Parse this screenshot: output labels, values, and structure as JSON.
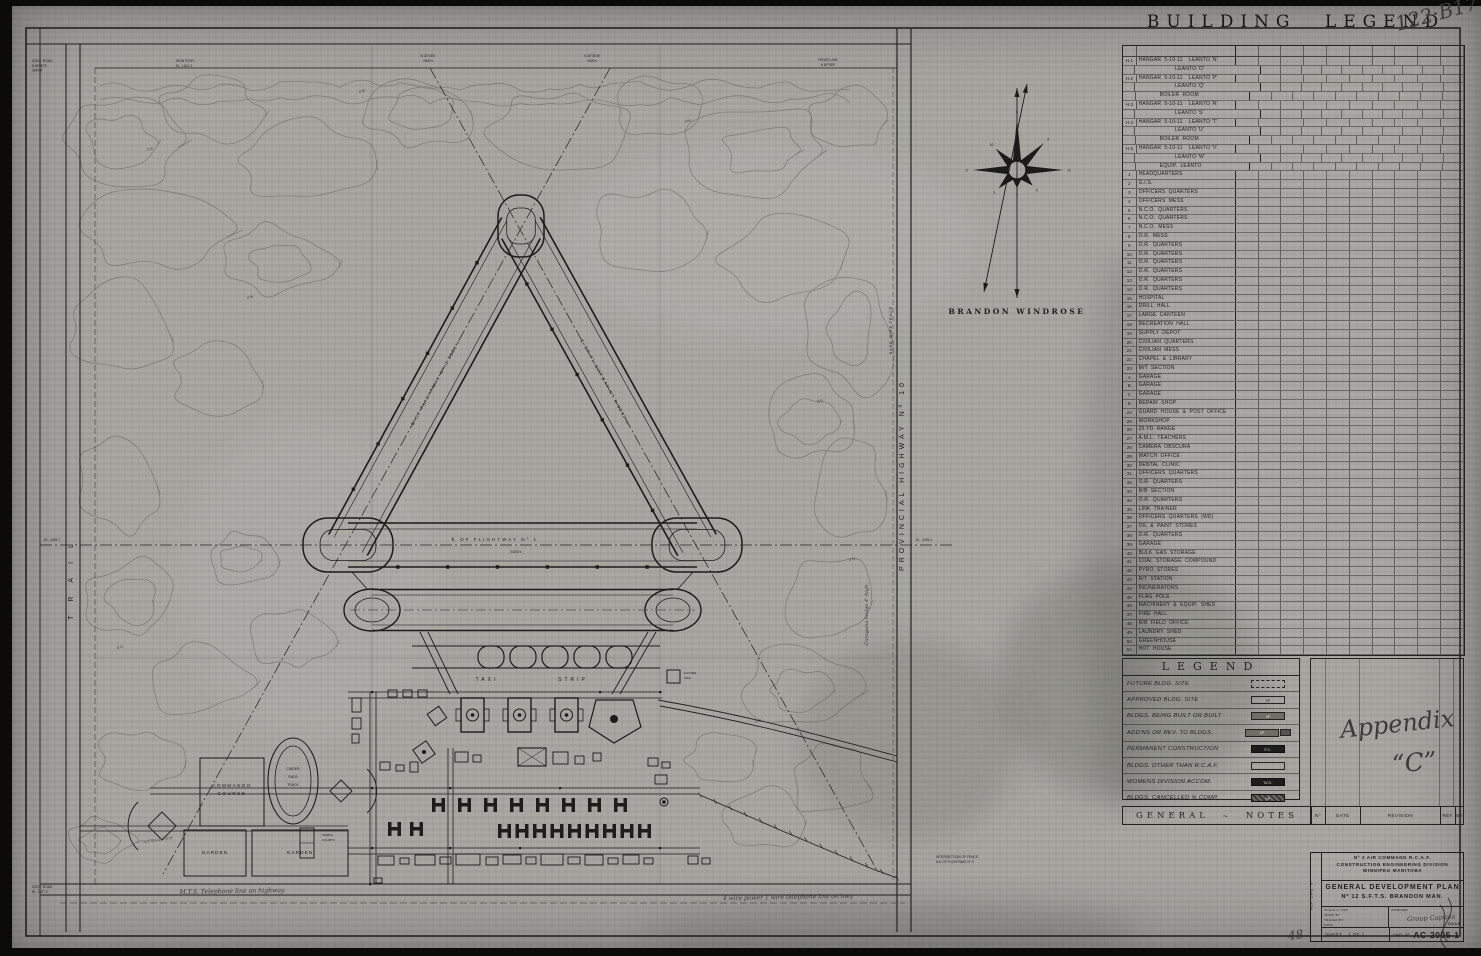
{
  "sheet": {
    "handwritten_ref": "122·B17",
    "handwritten_appendix_1": "Appendix",
    "handwritten_appendix_2": "“C”",
    "handwritten_48": "48"
  },
  "building_legend": {
    "title": "BUILDING LEGEND",
    "rows": [
      [
        "H.1",
        "HANGAR  5-10-11    LEANTO 'N'",
        0
      ],
      [
        "",
        "LEANTO 'O'",
        2
      ],
      [
        "H.2",
        "HANGAR  5-10-11    LEANTO 'P'",
        0
      ],
      [
        "",
        "LEANTO 'Q'",
        2
      ],
      [
        "",
        "BOILER  ROOM",
        1
      ],
      [
        "H.3",
        "HANGAR  5-10-11    LEANTO 'R'",
        0
      ],
      [
        "",
        "LEANTO 'S'",
        2
      ],
      [
        "H.4",
        "HANGAR  5-10-11    LEANTO 'T'",
        0
      ],
      [
        "",
        "LEANTO 'U'",
        2
      ],
      [
        "",
        "BOILER  ROOM",
        1
      ],
      [
        "H.5",
        "HANGAR  5-10-11    LEANTO 'V'",
        0
      ],
      [
        "",
        "LEANTO 'W'",
        2
      ],
      [
        "",
        "EQUIP.  LEANTO",
        1
      ],
      [
        "1",
        "HEADQUARTERS",
        0
      ],
      [
        "2",
        "G.I.S.",
        0
      ],
      [
        "3",
        "OFFICERS  QUARTERS",
        0
      ],
      [
        "4",
        "OFFICERS  MESS",
        0
      ],
      [
        "5",
        "N.C.O.  QUARTERS",
        0
      ],
      [
        "6",
        "N.C.O.  QUARTERS",
        0
      ],
      [
        "7",
        "N.C.O.  MESS",
        0
      ],
      [
        "8",
        "O.R.  MESS",
        0
      ],
      [
        "9",
        "O.R.  QUARTERS",
        0
      ],
      [
        "10",
        "O.R.  QUARTERS",
        0
      ],
      [
        "11",
        "O.R.  QUARTERS",
        0
      ],
      [
        "12",
        "O.R.  QUARTERS",
        0
      ],
      [
        "13",
        "O.R.  QUARTERS",
        0
      ],
      [
        "14",
        "O.R.  QUARTERS",
        0
      ],
      [
        "15",
        "HOSPITAL",
        0
      ],
      [
        "16",
        "DRILL  HALL",
        0
      ],
      [
        "17",
        "LARGE  CANTEEN",
        0
      ],
      [
        "18",
        "RECREATION  HALL",
        0
      ],
      [
        "19",
        "SUPPLY  DEPOT",
        0
      ],
      [
        "20",
        "CIVILIAN  QUARTERS",
        0
      ],
      [
        "21",
        "CIVILIAN  MESS",
        0
      ],
      [
        "22",
        "CHAPEL  &  LIBRARY",
        0
      ],
      [
        "23",
        "M/T  SECTION",
        0
      ],
      [
        "A",
        "GARAGE",
        0
      ],
      [
        "B",
        "GARAGE",
        0
      ],
      [
        "C",
        "GARAGE",
        0
      ],
      [
        "D",
        "REPAIR  SHOP",
        0
      ],
      [
        "24",
        "GUARD  HOUSE  &  POST  OFFICE",
        0
      ],
      [
        "25",
        "WORKSHOP",
        0
      ],
      [
        "26",
        "25 YD. RANGE",
        0
      ],
      [
        "27",
        "A.M.L.  TEACHERS",
        0
      ],
      [
        "28",
        "CAMERA  OBSCURA",
        0
      ],
      [
        "29",
        "WATCH  OFFICE",
        0
      ],
      [
        "30",
        "DENTAL  CLINIC",
        0
      ],
      [
        "31",
        "OFFICERS  QUARTERS",
        0
      ],
      [
        "32",
        "O.R.  QUARTERS",
        0
      ],
      [
        "33",
        "R/B  SECTION",
        0
      ],
      [
        "34",
        "O.R.  QUARTERS",
        0
      ],
      [
        "35",
        "LINK  TRAINER",
        0
      ],
      [
        "36",
        "OFFICERS  QUARTERS  (WD)",
        0
      ],
      [
        "37",
        "OIL  &  PAINT  STORES",
        0
      ],
      [
        "38",
        "O.R.  QUARTERS",
        0
      ],
      [
        "39",
        "GARAGE",
        0
      ],
      [
        "40",
        "BULK  GAS  STORAGE",
        0
      ],
      [
        "41",
        "COAL  STORAGE  COMPOUND",
        0
      ],
      [
        "42",
        "PYRO  STORES",
        0
      ],
      [
        "43",
        "R/T  STATION",
        0
      ],
      [
        "44",
        "INCINERATORS",
        0
      ],
      [
        "45",
        "FLAG  POLE",
        0
      ],
      [
        "46",
        "MACHINERY  &  EQUIP.  SHED",
        0
      ],
      [
        "47",
        "FIRE  HALL",
        0
      ],
      [
        "48",
        "R/B  FIELD  OFFICE",
        0
      ],
      [
        "49",
        "LAUNDRY  SHED",
        0
      ],
      [
        "50",
        "GREENHOUSE",
        0
      ],
      [
        "51",
        "HOT  HOUSE",
        0
      ]
    ]
  },
  "legend": {
    "title": "LEGEND",
    "items": [
      [
        "FUTURE BLDG. SITE",
        "dashed",
        ""
      ],
      [
        "APPROVED BLDG. SITE",
        "outline",
        "Nº"
      ],
      [
        "BLDGS. BEING BUILT OR BUILT",
        "filled",
        "Nº"
      ],
      [
        "ADD'NS OR REV. TO BLDGS.",
        "addn",
        "Nº"
      ],
      [
        "PERMANENT CONSTRUCTION",
        "solid",
        "P.C."
      ],
      [
        "BLDGS. OTHER THAN R.C.A.F.",
        "outline",
        ""
      ],
      [
        "WOMENS DIVISION ACCOM.",
        "solid",
        "W.D."
      ],
      [
        "BLDGS. CANCELLED % COMP.",
        "hatched",
        "Nº"
      ]
    ]
  },
  "general_notes": {
    "left": "GENERAL",
    "squiggle": "~",
    "right": "NOTES"
  },
  "revision": {
    "no": "Nº",
    "date": "DATE",
    "revision": "REVISION",
    "ref": "REF.",
    "by": "BY"
  },
  "title_block": {
    "org_line1": "Nº 2 AIR COMMAND  R.C.A.F.",
    "org_line2": "CONSTRUCTION  ENGINEERING  DIVISION",
    "org_line3": "WINNIPEG        MANITOBA",
    "plan_line1": "GENERAL DEVELOPMENT PLAN",
    "plan_line2": "Nº 12  S.F.T.S.    BRANDON  MAN.",
    "scale_label": "SCALE",
    "scale_value": "1\"=200'",
    "work_by": "WORK BY",
    "traced_by": "TRACED BY",
    "date_label": "DATE",
    "approved_label": "APPROVED",
    "approved_sig": "Group Captain",
    "approved_org": "D.G.C.E.",
    "sheet_label": "SHEET",
    "sheet_value": "1 OF 1",
    "dwg_label": "DWG. Nº",
    "dwg_value": "AC-2005-1",
    "side_label": "REF. DWG. Nº"
  },
  "map": {
    "labels": {
      "trail": "TRAIL",
      "highway": "PROVINCIAL   HIGHWAY   Nº 10",
      "barb_fence": "BARB WIRE FENCE",
      "flightway1": "℄ OF FLIGHTWAY Nº 1",
      "flightway1_len": "3300'±",
      "flightway2": "℄ OF FLIGHTWAY Nº 2   3300'±",
      "flightway3": "℄ OF FLIGHTWAY Nº 3   3300'±",
      "taxi": "TAXI",
      "strip": "STRIP",
      "commando1": "COMMANDO",
      "commando2": "COURSE",
      "race1": "CINDER",
      "race2": "RACE",
      "race3": "TRACK",
      "garden": "GARDEN",
      "tennis1": "TENNIS",
      "tennis2": "COURTS",
      "softball": "SOFTBALL PITCH",
      "future1": "FUTURE",
      "future2": "SITE",
      "windrose": "BRANDON  WINDROSE",
      "tel_west": "M.T.S. Telephone line on highway",
      "tel_east": "4 wire power 1 wire telephone line on hwy",
      "caragana": "Caragana hedge 4' high",
      "el_west": "EL. 1198.7",
      "el_east": "EL. 1196.4"
    },
    "notes": {
      "nw": [
        "GOVT. ROAD",
        "N 89°52'E",
        "2640.5'"
      ],
      "nw2": [
        "IRON POST",
        "EL. 1201.3"
      ],
      "n1": [
        "N 30°26'E",
        "2640'±"
      ],
      "n2": [
        "N 30°26'W",
        "2640'±"
      ],
      "ne": [
        "FENCE LINE",
        "N 89°55'E"
      ],
      "sw": [
        "GOVT. ROAD",
        "EL. 1197.2"
      ],
      "intersection": [
        "INTERSECTION OF FENCE",
        "& ℄ OF FLIGHTWAY Nº 3"
      ]
    },
    "contour_elevations": [
      "1190",
      "1195",
      "1200",
      "1185",
      "1192",
      "1188",
      "1196",
      "1194"
    ],
    "windrose_values": [
      "8",
      "4",
      "12",
      "6",
      "3",
      "2",
      "5",
      "10"
    ]
  }
}
